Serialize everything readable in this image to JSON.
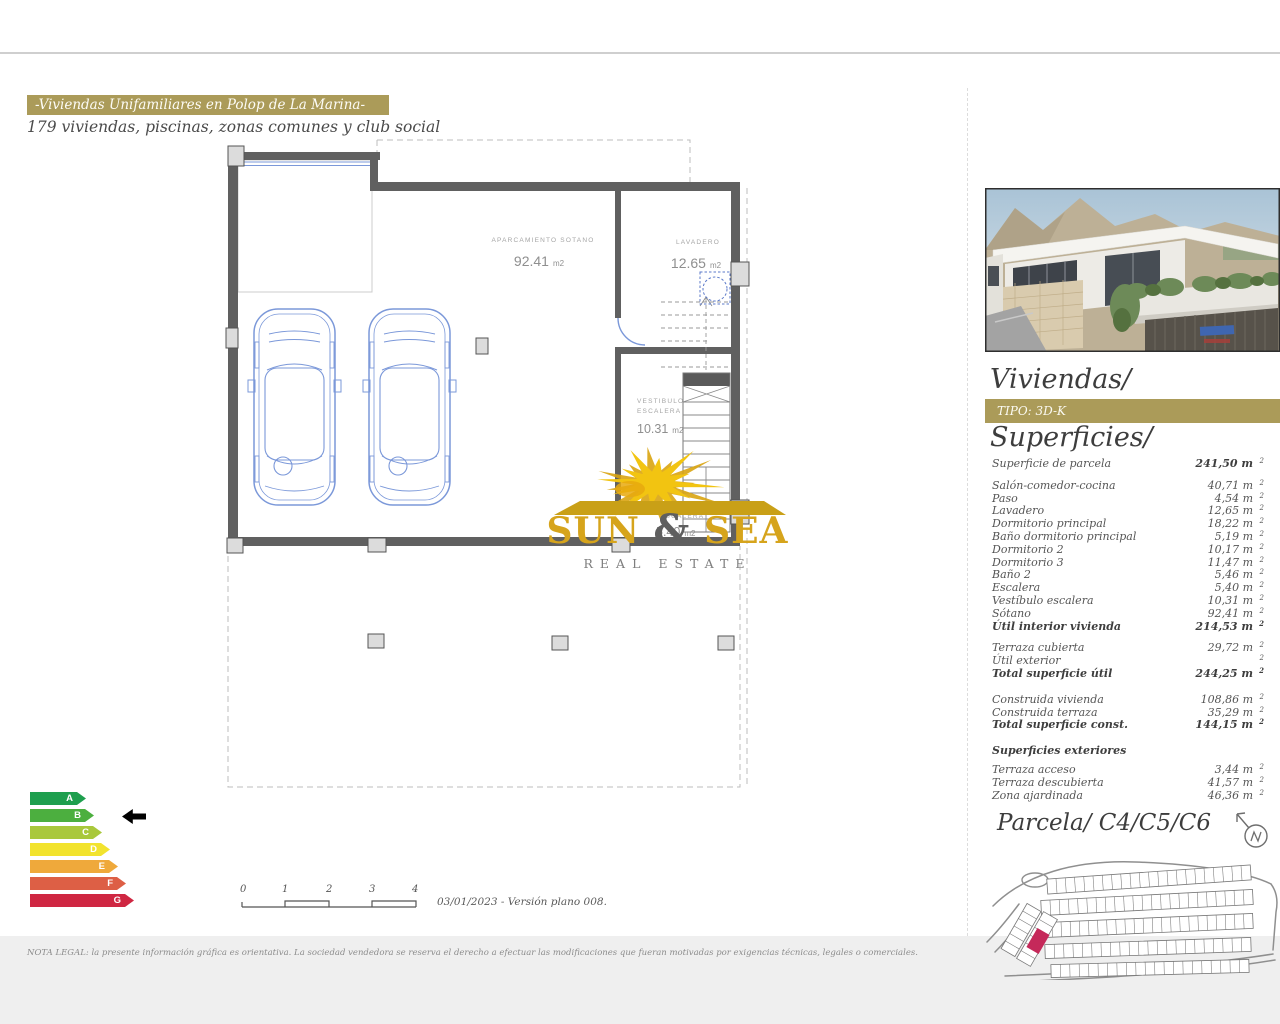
{
  "header": {
    "title": "-Viviendas Unifamiliares en Polop de La Marina-",
    "subtitle": "179 viviendas, piscinas, zonas comunes y club social"
  },
  "plan": {
    "parking_name": "APARCAMIENTO SOTANO",
    "parking_area": "92.41",
    "parking_unit": "m2",
    "laundry_name": "LAVADERO",
    "laundry_area": "12.65",
    "laundry_unit": "m2",
    "vest_line1": "VESTIBULO",
    "vest_line2": "ESCALERA",
    "vest_area": "10.31",
    "vest_unit": "m2",
    "stairs_name": "ESCALERA",
    "stairs_area": "5.40",
    "stairs_unit": "m2"
  },
  "logo": {
    "word1": "SUN",
    "amp": "&",
    "word2": "SEA",
    "tagline": "REAL ESTATE"
  },
  "panel": {
    "viviendas_title": "Viviendas/",
    "tipo": "TIPO: 3D-K",
    "superficies_title": "Superficies/",
    "parcela_title": "Parcela/ C4/C5/C6",
    "table": [
      {
        "label": "Superficie de parcela",
        "value": "241,50 m",
        "sup": "2",
        "vbold": true
      },
      {
        "label": "Salón-comedor-cocina",
        "value": "40,71 m",
        "sup": "2",
        "sp": "md"
      },
      {
        "label": "Paso",
        "value": "4,54 m",
        "sup": "2"
      },
      {
        "label": "Lavadero",
        "value": "12,65 m",
        "sup": "2"
      },
      {
        "label": "Dormitorio principal",
        "value": "18,22 m",
        "sup": "2"
      },
      {
        "label": "Baño dormitorio principal",
        "value": "5,19 m",
        "sup": "2"
      },
      {
        "label": "Dormitorio 2",
        "value": "10,17 m",
        "sup": "2"
      },
      {
        "label": "Dormitorio 3",
        "value": "11,47 m",
        "sup": "2"
      },
      {
        "label": "Baño 2",
        "value": "5,46 m",
        "sup": "2"
      },
      {
        "label": "Escalera",
        "value": "5,40 m",
        "sup": "2"
      },
      {
        "label": "Vestíbulo escalera",
        "value": "10,31 m",
        "sup": "2"
      },
      {
        "label": "Sótano",
        "value": "92,41 m",
        "sup": "2"
      },
      {
        "label": "Útil interior vivienda",
        "value": "214,53 m",
        "sup": "2",
        "bold": true
      },
      {
        "label": "Terraza cubierta",
        "value": "29,72 m",
        "sup": "2",
        "sp": "md"
      },
      {
        "label": "Útil exterior",
        "value": "",
        "sup": "2"
      },
      {
        "label": "Total superficie útil",
        "value": "244,25 m",
        "sup": "2",
        "bold": true
      },
      {
        "label": "Construida vivienda",
        "value": "108,86 m",
        "sup": "2",
        "sp": "lg"
      },
      {
        "label": "Construida terraza",
        "value": "35,29 m",
        "sup": "2"
      },
      {
        "label": "Total superficie const.",
        "value": "144,15 m",
        "sup": "2",
        "bold": true
      },
      {
        "label": "Superficies exteriores",
        "value": "",
        "sup": "",
        "bold": true,
        "sp": "lg",
        "subhead": true
      },
      {
        "label": "Terraza acceso",
        "value": "3,44 m",
        "sup": "2",
        "sp": "sm"
      },
      {
        "label": "Terraza descubierta",
        "value": "41,57 m",
        "sup": "2"
      },
      {
        "label": "Zona ajardinada",
        "value": "46,36 m",
        "sup": "2"
      }
    ]
  },
  "energy": {
    "active": "B",
    "levels": [
      {
        "letter": "A",
        "color": "#1e9f4e",
        "width": 56
      },
      {
        "letter": "B",
        "color": "#4caf3f",
        "width": 64
      },
      {
        "letter": "C",
        "color": "#a9c83b",
        "width": 72
      },
      {
        "letter": "D",
        "color": "#f2e32e",
        "width": 80
      },
      {
        "letter": "E",
        "color": "#efa93b",
        "width": 88
      },
      {
        "letter": "F",
        "color": "#dd5f45",
        "width": 96
      },
      {
        "letter": "G",
        "color": "#cf2742",
        "width": 104
      }
    ]
  },
  "scalebar": {
    "ticks": [
      "0",
      "1",
      "2",
      "3",
      "4"
    ]
  },
  "meta": {
    "version": "03/01/2023 - Versión plano 008."
  },
  "legal": "NOTA LEGAL: la presente información gráfica es orientativa. La sociedad vendedora se reserva el derecho a efectuar las modificaciones que fueran motivadas por exigencias técnicas, legales o comerciales.",
  "colors": {
    "gold": "#ab9b59",
    "wall": "#606060",
    "car_blue": "#7b98d9",
    "parcel_highlight": "#c5295a",
    "sun_yellow": "#f2c411",
    "logo_gold": "#d6a41c"
  }
}
